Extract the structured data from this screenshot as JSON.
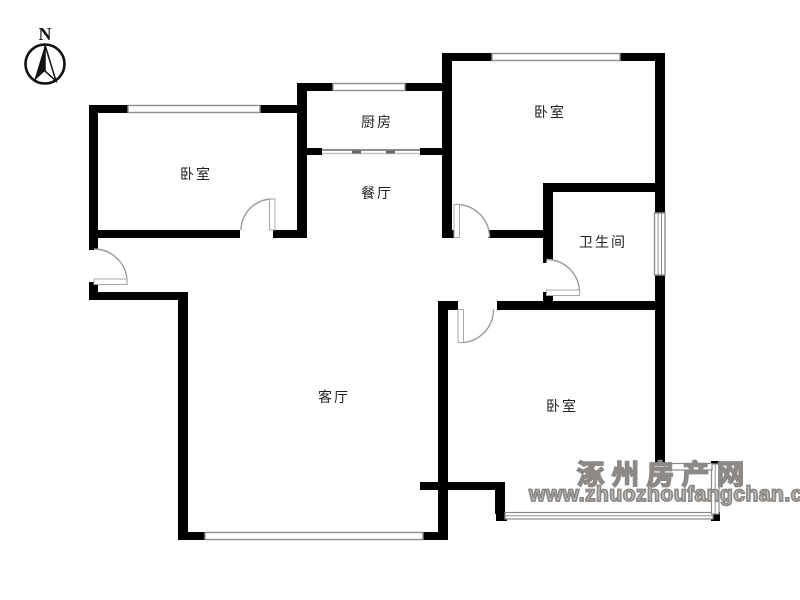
{
  "compass": {
    "label": "N"
  },
  "rooms": {
    "bedroom_left": "卧室",
    "kitchen": "厨房",
    "dining": "餐厅",
    "bedroom_top_right": "卧室",
    "bathroom": "卫生间",
    "living": "客厅",
    "bedroom_bottom_right": "卧室"
  },
  "watermark": {
    "site_name": "涿州房产网",
    "site_url": "www.zhuozhoufangchan.com"
  },
  "colors": {
    "wall": "#000000",
    "window_line": "#8f8f8f",
    "door_line": "#9c9c9c",
    "label_text": "#1f1f1f",
    "watermark": "#8d8987"
  }
}
